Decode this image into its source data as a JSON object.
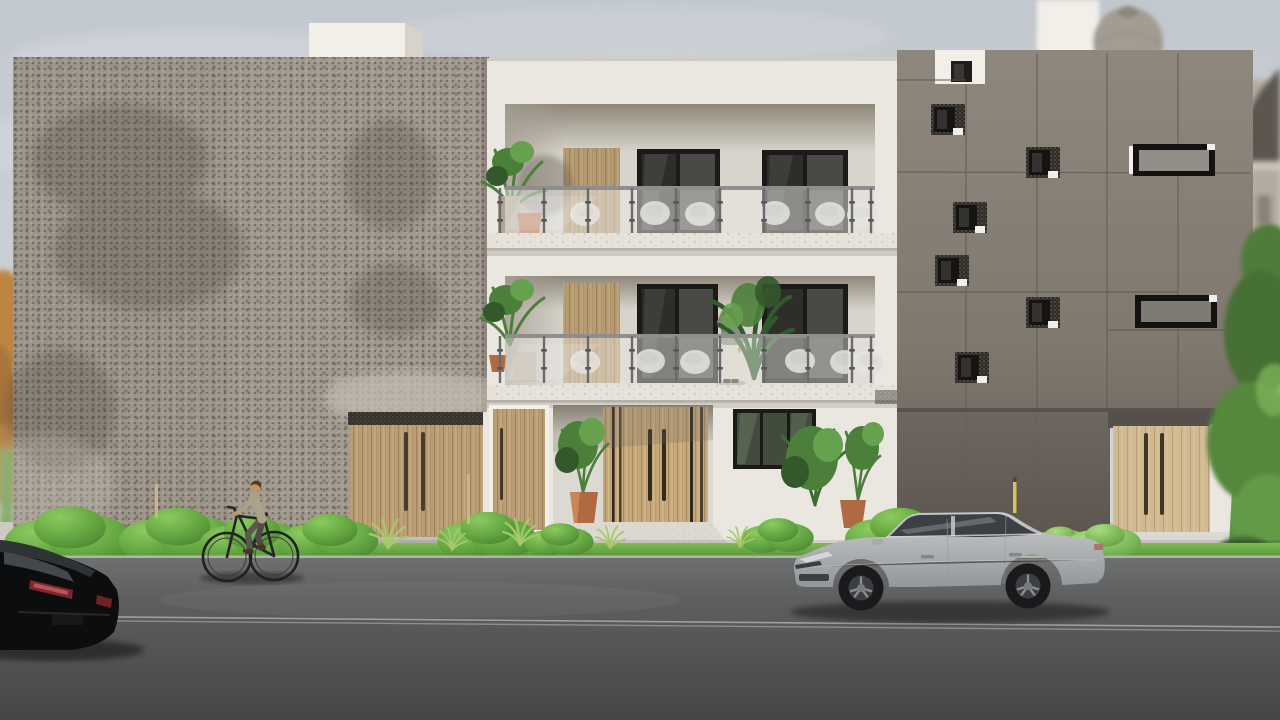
{
  "meta": {
    "kind": "3d-architectural-street-render",
    "visible_text": ""
  },
  "scene": {
    "objects": {
      "sky": "Overcast pale sky",
      "parapet": "White rooftop volume behind left facade",
      "dome": "Blurred classical dome in background",
      "classical_building": "Blurred classical building at right edge",
      "tree_left": "Autumn tree at far left edge",
      "trees_right": "Green trees at far right edge",
      "left_building": "Building with perforated metal facade",
      "garage_left": "Wooden garage door of left building",
      "center_building": "White three-storey apartment building",
      "balcony_upper": "Third floor balcony with glass railing",
      "balcony_middle": "Second floor balcony with glass railing",
      "balcony_person": "Person on balcony talking on phone",
      "entrance_door": "Wooden double entrance door with tall handles",
      "side_door": "Narrow wooden side door",
      "ground_window": "Ground floor window",
      "right_building": "Dark panelled building with scattered square windows",
      "garage_right": "Wooden garage door of right building",
      "sidewalk": "Concrete sidewalk",
      "grass": "Grass strip with shrubs and tufts",
      "road": "Asphalt road with lane line",
      "silver_car": "Silver sedan parked facing left",
      "black_car": "Black car at left edge of street",
      "cyclist": "Person riding bicycle to the left"
    }
  },
  "colors": {
    "sky_top": "#c2c8cf",
    "sky_low": "#dadcda",
    "perf_base": "#9d948a",
    "white_wall": "#eae7e1",
    "white_bright": "#f2efe9",
    "recess_wall": "#d8d4cb",
    "recess_shadow": "#8e8779",
    "slab": "#e7e3da",
    "wood_mid": "#c7a87b",
    "wood_light": "#d8bf95",
    "wood_stripe": "#2e2920",
    "win_frame": "#1b1a18",
    "win_glass": "#2e2d2a",
    "win_glass_light": "#4a4945",
    "ground_glass": "#414c3d",
    "panel_dark": "#8e877d",
    "panel_dark_low": "#6e6760",
    "panel_seam": "#5f5951",
    "hw_glass": "#918e87",
    "steel": "#6b6b6e",
    "railing_glass": "#ecebe7",
    "sidewalk": "#cccac4",
    "walkway": "#dcd9d3",
    "road_top": "#6e7071",
    "road_low": "#454647",
    "road_line": "#a6a7a5",
    "grass_light": "#7fba52",
    "grass_dark": "#55903a",
    "bush_light": "#8dca60",
    "bush_dark": "#4b8132",
    "leaf_dark": "#33582b",
    "leaf_mid": "#4b7f3a",
    "leaf_light": "#66a24d",
    "terracotta": "#b06a42",
    "car_body": "#c6c8ca",
    "car_body_low": "#94979a",
    "car_glass": "#3c4044",
    "black_car": "#0c0d0e",
    "tail_red": "#7e262b",
    "skin": "#c0946c",
    "shirt_gray": "#8f8d82",
    "pants_cream": "#d8d1c1",
    "shirt_khaki": "#aba387",
    "pants_olive": "#5b564e",
    "autumn": "#bd8443",
    "dome": "#a39c93",
    "classical": "#b2aba1",
    "roof_dark": "#5b564f"
  }
}
